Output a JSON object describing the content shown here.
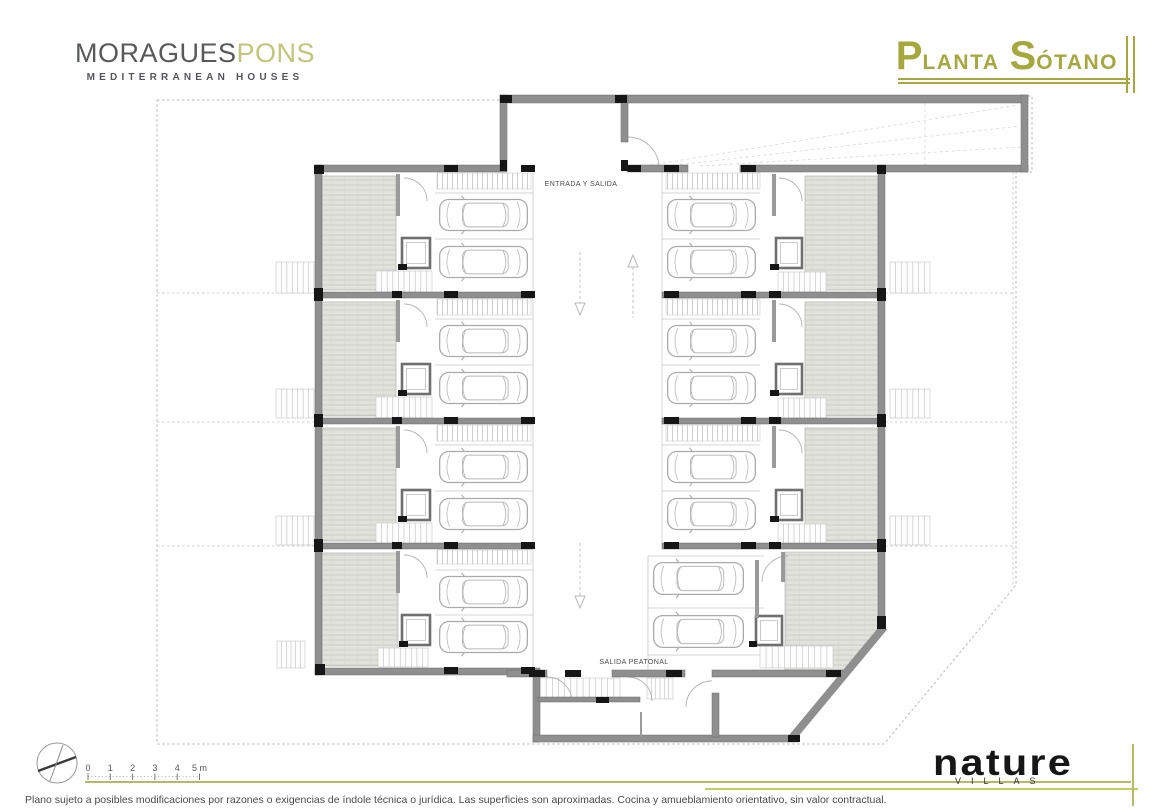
{
  "brand": {
    "name_primary": "MORAGUES",
    "name_secondary": "PONS",
    "tagline": "MEDITERRANEAN HOUSES"
  },
  "title": {
    "word1_big": "P",
    "word1_rest": "LANTA",
    "word2_big": "S",
    "word2_rest": "ÓTANO"
  },
  "footer": {
    "logo": "nature",
    "logo_sub": "VILLAS",
    "disclaimer": "Plano sujeto a posibles modificaciones por razones o exigencias de índole técnica o jurídica. Las superficies son aproximadas. Cocina y amueblamiento orientativo, sin valor contractual."
  },
  "scale_bar": {
    "x0": 88,
    "dx": 22.3,
    "y": 771,
    "labels": [
      "0",
      "1",
      "2",
      "3",
      "4",
      "5 m"
    ]
  },
  "colors": {
    "accent_olive": "#a6a83e",
    "accent_light_olive": "#c3c577",
    "accent_green": "#bdd15c",
    "wall_gray": "#8f8f8f",
    "column_black": "#161616"
  },
  "plan": {
    "texts": [
      {
        "x": 581,
        "y": 186,
        "t": "ENTRADA Y SALIDA"
      },
      {
        "x": 634,
        "y": 664,
        "t": "SALIDA PEATONAL"
      }
    ],
    "site_polygon": "157,100 505,100 505,96 1032,96 1032,172 1016,172 1016,585 884,744 157,744",
    "divisions": [
      [
        157,
        293,
        315,
        293
      ],
      [
        157,
        422,
        315,
        422
      ],
      [
        157,
        546,
        315,
        546
      ],
      [
        885,
        293,
        1013,
        293
      ],
      [
        885,
        422,
        1013,
        422
      ],
      [
        885,
        546,
        1013,
        546
      ],
      [
        1013,
        172,
        1013,
        585
      ]
    ],
    "guides": [
      [
        645,
        166,
        1018,
        105
      ],
      [
        668,
        166,
        1020,
        126
      ],
      [
        700,
        166,
        1022,
        147
      ],
      [
        925,
        103,
        925,
        165
      ]
    ],
    "walls": [
      [
        315,
        165,
        185,
        7
      ],
      [
        627,
        165,
        61,
        7
      ],
      [
        740,
        165,
        288,
        7
      ],
      [
        500,
        95,
        528,
        8
      ],
      [
        500,
        95,
        7,
        77
      ],
      [
        621,
        95,
        7,
        47
      ],
      [
        1021,
        95,
        7,
        77
      ],
      [
        315,
        165,
        7,
        510
      ],
      [
        315,
        292,
        218,
        6
      ],
      [
        315,
        418,
        218,
        6
      ],
      [
        315,
        543,
        218,
        6
      ],
      [
        315,
        668,
        225,
        7
      ],
      [
        533,
        675,
        7,
        67
      ],
      [
        533,
        735,
        265,
        7
      ],
      [
        878,
        165,
        7,
        463
      ],
      [
        662,
        292,
        223,
        6
      ],
      [
        662,
        418,
        223,
        6
      ],
      [
        662,
        543,
        223,
        6
      ],
      [
        712,
        670,
        131,
        7
      ],
      [
        507,
        670,
        40,
        7
      ],
      [
        612,
        670,
        73,
        7
      ],
      [
        712,
        693,
        7,
        44
      ],
      [
        538,
        697,
        102,
        5
      ]
    ],
    "chamfer": [
      791,
      739,
      884,
      627
    ],
    "partitions": [
      [
        396,
        174,
        4,
        42
      ],
      [
        396,
        300,
        4,
        42
      ],
      [
        396,
        426,
        4,
        42
      ],
      [
        396,
        551,
        4,
        42
      ],
      [
        772,
        174,
        4,
        42
      ],
      [
        772,
        300,
        4,
        42
      ],
      [
        772,
        426,
        4,
        42
      ],
      [
        755,
        560,
        4,
        58
      ],
      [
        781,
        552,
        4,
        30
      ],
      [
        640,
        712,
        2,
        25
      ]
    ],
    "hatches": [
      [
        322,
        176,
        74,
        114
      ],
      [
        322,
        302,
        74,
        114
      ],
      [
        322,
        428,
        74,
        113
      ],
      [
        322,
        553,
        76,
        113
      ],
      [
        805,
        176,
        73,
        114
      ],
      [
        805,
        302,
        73,
        114
      ],
      [
        805,
        428,
        73,
        113
      ]
    ],
    "hatch_polys": [
      "785,552 881,552 881,627 843,671 785,671"
    ],
    "bands": [
      [
        437,
        173,
        94,
        16
      ],
      [
        437,
        299,
        94,
        16
      ],
      [
        437,
        425,
        94,
        16
      ],
      [
        437,
        550,
        94,
        14
      ],
      [
        666,
        173,
        94,
        16
      ],
      [
        666,
        299,
        94,
        16
      ],
      [
        666,
        425,
        94,
        16
      ]
    ],
    "cars": [
      [
        436,
        194,
        95,
        42
      ],
      [
        436,
        241,
        95,
        42
      ],
      [
        436,
        320,
        95,
        42
      ],
      [
        436,
        367,
        95,
        42
      ],
      [
        436,
        446,
        95,
        42
      ],
      [
        436,
        493,
        95,
        42
      ],
      [
        436,
        571,
        95,
        42
      ],
      [
        436,
        616,
        95,
        42
      ],
      [
        664,
        194,
        95,
        42
      ],
      [
        664,
        241,
        95,
        42
      ],
      [
        664,
        320,
        95,
        42
      ],
      [
        664,
        367,
        95,
        42
      ],
      [
        664,
        446,
        95,
        42
      ],
      [
        664,
        493,
        95,
        42
      ],
      [
        650,
        557,
        97,
        43
      ],
      [
        650,
        610,
        97,
        43
      ]
    ],
    "stall_h": [
      [
        435,
        193,
        533,
        193
      ],
      [
        435,
        239,
        533,
        239
      ],
      [
        435,
        319,
        533,
        319
      ],
      [
        435,
        365,
        533,
        365
      ],
      [
        435,
        445,
        533,
        445
      ],
      [
        435,
        491,
        533,
        491
      ],
      [
        435,
        570,
        533,
        570
      ],
      [
        435,
        615,
        533,
        615
      ],
      [
        662,
        193,
        760,
        193
      ],
      [
        662,
        239,
        760,
        239
      ],
      [
        662,
        319,
        760,
        319
      ],
      [
        662,
        365,
        760,
        365
      ],
      [
        662,
        445,
        760,
        445
      ],
      [
        662,
        491,
        760,
        491
      ],
      [
        648,
        556,
        764,
        556
      ],
      [
        648,
        608,
        764,
        608
      ],
      [
        648,
        655,
        764,
        655
      ]
    ],
    "stall_v": [
      [
        533,
        172,
        533,
        668
      ],
      [
        662,
        172,
        662,
        543
      ],
      [
        648,
        556,
        648,
        670
      ]
    ],
    "elevators": [
      [
        402,
        238,
        28,
        30
      ],
      [
        402,
        364,
        28,
        30
      ],
      [
        402,
        490,
        28,
        30
      ],
      [
        402,
        615,
        28,
        30
      ],
      [
        776,
        238,
        26,
        30
      ],
      [
        776,
        364,
        26,
        30
      ],
      [
        776,
        490,
        26,
        30
      ],
      [
        756,
        616,
        26,
        29
      ]
    ],
    "stairs": [
      [
        376,
        271,
        56,
        21,
        9
      ],
      [
        376,
        397,
        56,
        21,
        9
      ],
      [
        376,
        523,
        56,
        21,
        9
      ],
      [
        378,
        648,
        50,
        19,
        8
      ],
      [
        778,
        272,
        48,
        20,
        8
      ],
      [
        778,
        398,
        48,
        20,
        8
      ],
      [
        778,
        524,
        48,
        20,
        8
      ],
      [
        760,
        646,
        73,
        22,
        11
      ],
      [
        540,
        678,
        80,
        21,
        12
      ],
      [
        647,
        678,
        26,
        21,
        5
      ],
      [
        276,
        262,
        38,
        31,
        6
      ],
      [
        276,
        389,
        38,
        29,
        6
      ],
      [
        276,
        516,
        38,
        29,
        6
      ],
      [
        277,
        641,
        28,
        27,
        5
      ],
      [
        890,
        262,
        40,
        31,
        6
      ],
      [
        890,
        389,
        40,
        29,
        6
      ],
      [
        890,
        516,
        40,
        29,
        6
      ]
    ],
    "arcs": [
      "M404 178 a23 23 0 0 1 23 23",
      "M404 304 a23 23 0 0 1 23 23",
      "M404 430 a23 23 0 0 1 23 23",
      "M404 555 a23 23 0 0 1 23 23",
      "M779 178 a23 23 0 0 1 23 23",
      "M779 304 a23 23 0 0 1 23 23",
      "M779 430 a23 23 0 0 1 23 23",
      "M788 556 a26 26 0 0 0 -26 26",
      "M628 137 A31 31 0 0 1 659 168",
      "M547 677 a25 25 0 0 1 25 25",
      "M628 677 a24 24 0 0 1 24 24",
      "M712 681 a26 26 0 0 0 -26 26"
    ],
    "columns": [
      [
        444,
        165,
        14,
        7
      ],
      [
        521,
        165,
        14,
        7
      ],
      [
        628,
        165,
        13,
        7
      ],
      [
        664,
        165,
        15,
        7
      ],
      [
        741,
        165,
        15,
        7
      ],
      [
        500,
        95,
        12,
        8
      ],
      [
        615,
        95,
        12,
        8
      ],
      [
        500,
        160,
        7,
        11
      ],
      [
        621,
        160,
        7,
        11
      ],
      [
        444,
        291,
        14,
        7
      ],
      [
        521,
        291,
        14,
        7
      ],
      [
        664,
        291,
        15,
        7
      ],
      [
        741,
        291,
        15,
        7
      ],
      [
        392,
        291,
        10,
        7
      ],
      [
        769,
        291,
        12,
        7
      ],
      [
        444,
        417,
        14,
        7
      ],
      [
        521,
        417,
        14,
        7
      ],
      [
        664,
        417,
        15,
        7
      ],
      [
        741,
        417,
        15,
        7
      ],
      [
        392,
        417,
        10,
        7
      ],
      [
        769,
        417,
        12,
        7
      ],
      [
        444,
        542,
        14,
        7
      ],
      [
        521,
        542,
        14,
        7
      ],
      [
        664,
        542,
        15,
        7
      ],
      [
        741,
        542,
        15,
        7
      ],
      [
        392,
        542,
        10,
        7
      ],
      [
        769,
        542,
        12,
        7
      ],
      [
        444,
        667,
        14,
        7
      ],
      [
        521,
        667,
        14,
        7
      ],
      [
        314,
        165,
        10,
        9
      ],
      [
        314,
        288,
        9,
        13
      ],
      [
        314,
        414,
        9,
        13
      ],
      [
        314,
        539,
        9,
        13
      ],
      [
        315,
        664,
        10,
        11
      ],
      [
        877,
        165,
        9,
        9
      ],
      [
        877,
        288,
        9,
        13
      ],
      [
        877,
        414,
        9,
        13
      ],
      [
        877,
        539,
        9,
        13
      ],
      [
        877,
        616,
        9,
        13
      ],
      [
        529,
        670,
        16,
        7
      ],
      [
        565,
        670,
        16,
        7
      ],
      [
        666,
        670,
        16,
        7
      ],
      [
        596,
        697,
        13,
        6
      ],
      [
        826,
        670,
        15,
        7
      ],
      [
        788,
        735,
        12,
        7
      ],
      [
        398,
        264,
        9,
        6
      ],
      [
        398,
        390,
        9,
        6
      ],
      [
        398,
        516,
        9,
        6
      ],
      [
        399,
        641,
        9,
        6
      ],
      [
        770,
        264,
        9,
        6
      ],
      [
        770,
        390,
        9,
        6
      ],
      [
        770,
        516,
        9,
        6
      ],
      [
        749,
        641,
        8,
        6
      ]
    ],
    "arrows": [
      {
        "x": 580,
        "y1": 252,
        "y2": 315,
        "dir": "down"
      },
      {
        "x": 633,
        "y1": 255,
        "y2": 318,
        "dir": "up"
      },
      {
        "x": 580,
        "y1": 543,
        "y2": 608,
        "dir": "down"
      }
    ]
  }
}
